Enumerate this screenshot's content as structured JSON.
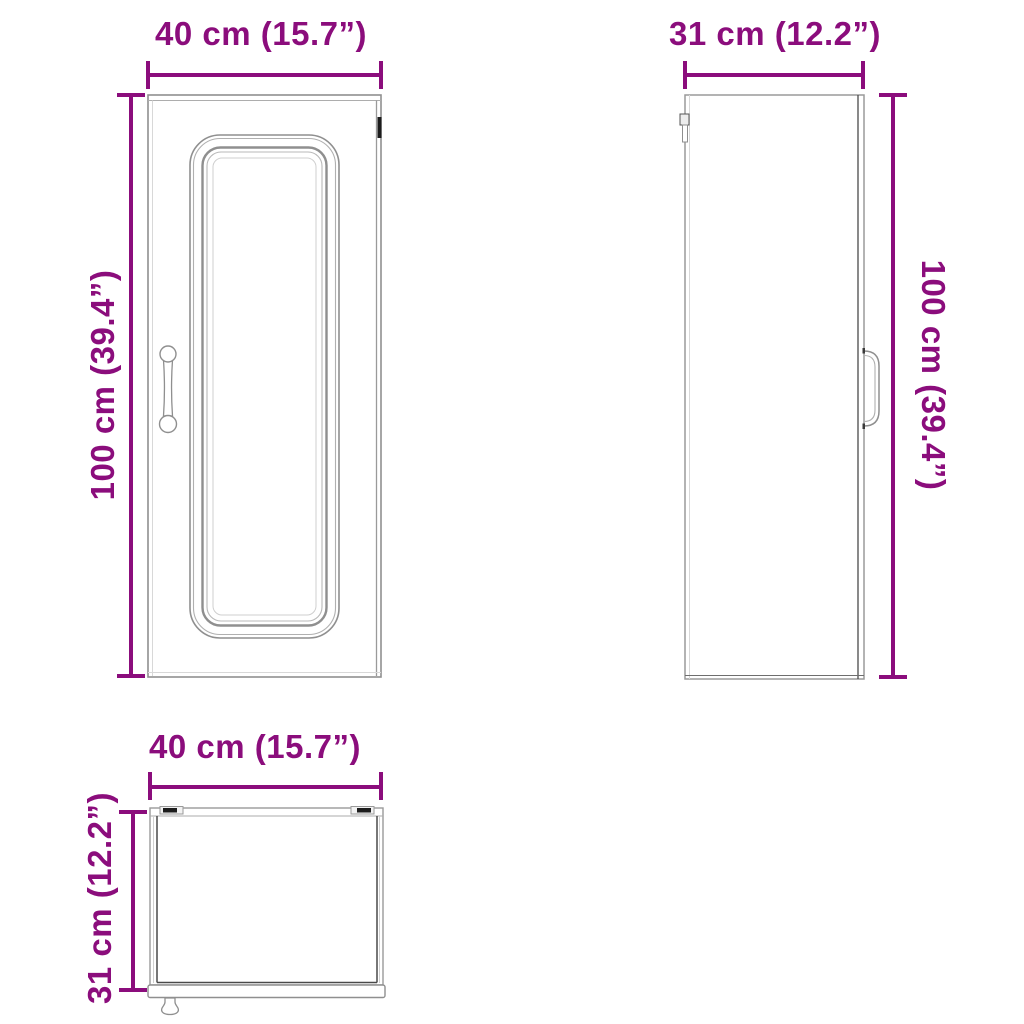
{
  "diagram": {
    "title": "wall-cabinet-dimension-drawing",
    "accent_color": "#8B0D7C",
    "line_color": "#8F8F8F",
    "dark_line_color": "#4A4A4A",
    "views": {
      "front": {
        "width_label": "40 cm (15.7”)",
        "height_label": "100 cm (39.4”)"
      },
      "side": {
        "width_label": "31 cm (12.2”)",
        "height_label": "100 cm (39.4”)"
      },
      "top": {
        "width_label": "40 cm (15.7”)",
        "depth_label": "31 cm (12.2”)"
      }
    }
  }
}
